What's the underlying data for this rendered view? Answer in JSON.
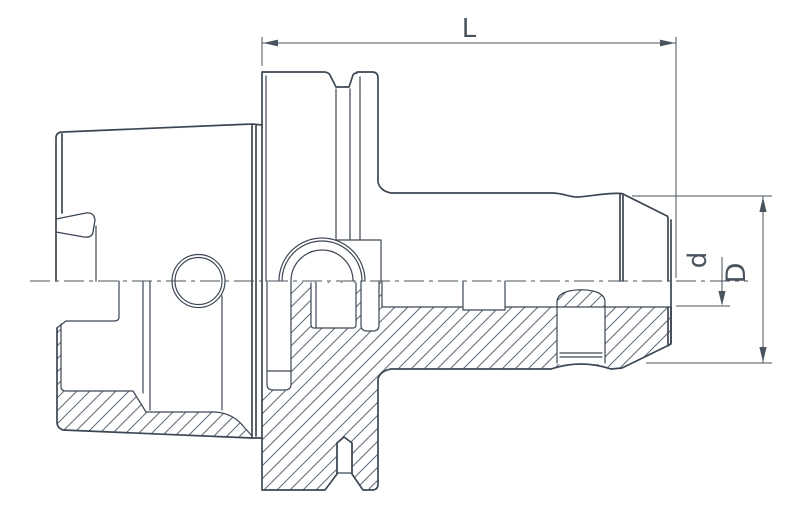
{
  "drawing": {
    "labels": {
      "length": "L",
      "bore_diameter": "d",
      "outer_diameter": "D"
    },
    "colors": {
      "line": "#3d4753",
      "hatch": "#5d6975",
      "dimension": "#49535e",
      "background": "#ffffff"
    }
  }
}
